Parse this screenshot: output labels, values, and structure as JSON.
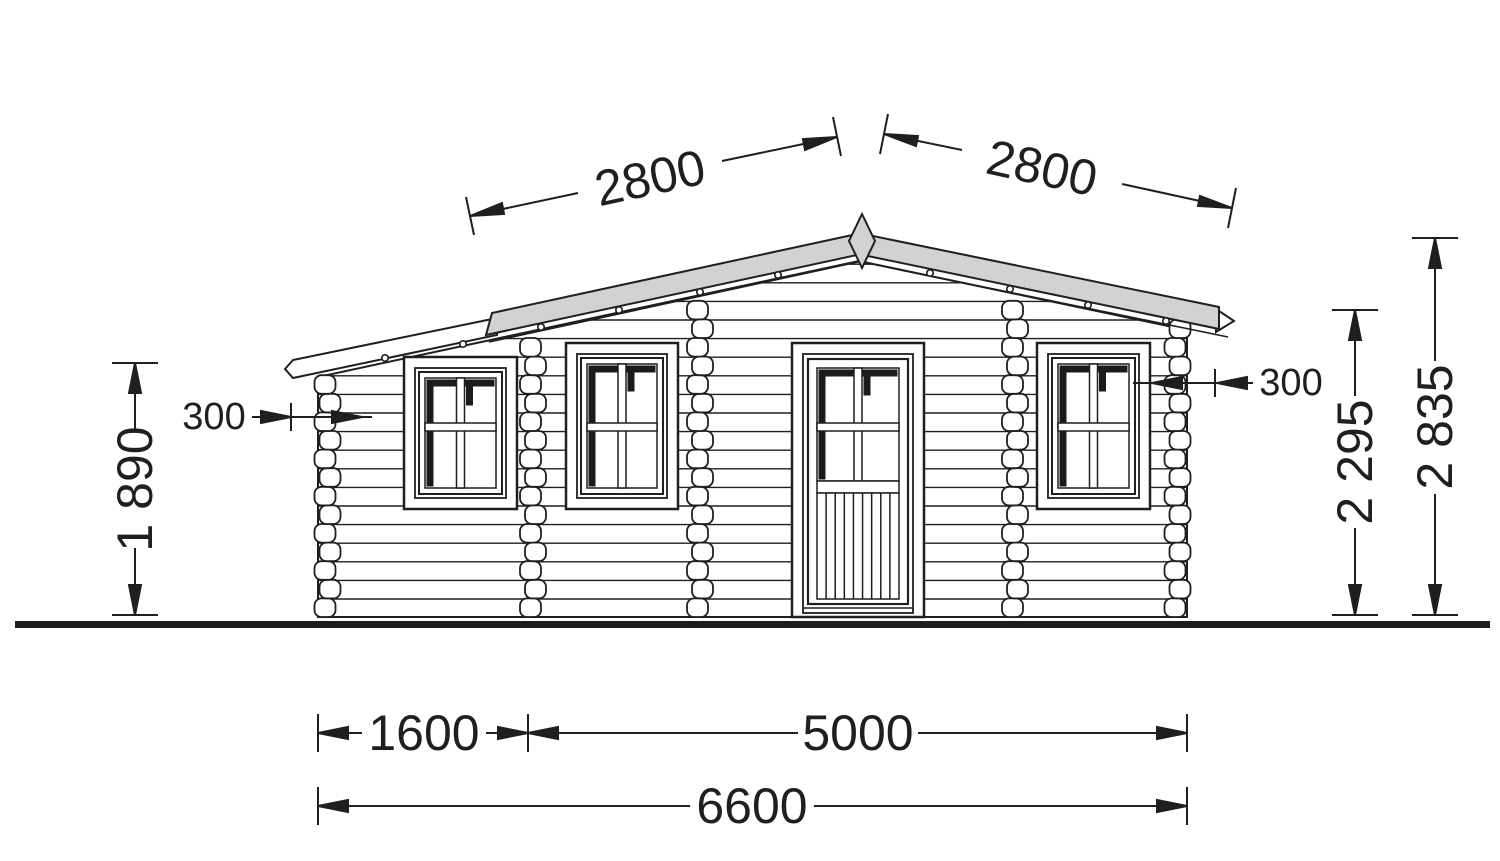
{
  "drawing": {
    "kind": "log-cabin front elevation, technical drawing",
    "dimensions": {
      "roof_slope_left": {
        "label": "2800"
      },
      "roof_slope_right": {
        "label": "2800"
      },
      "overhang_left": {
        "label": "300"
      },
      "overhang_right": {
        "label": "300"
      },
      "wall_height_left": {
        "label": "1 890"
      },
      "eave_height_right": {
        "label": "2 295"
      },
      "ridge_height": {
        "label": "2 835"
      },
      "annex_width": {
        "label": "1600"
      },
      "main_width": {
        "label": "5000"
      },
      "total_width": {
        "label": "6600"
      }
    },
    "colors": {
      "line": "#1f1f1f",
      "roof_fill": "#d2d2d2",
      "glazing_shadow": "#1b1b1b",
      "ground": "#1c1c1c",
      "background": "#ffffff"
    }
  }
}
